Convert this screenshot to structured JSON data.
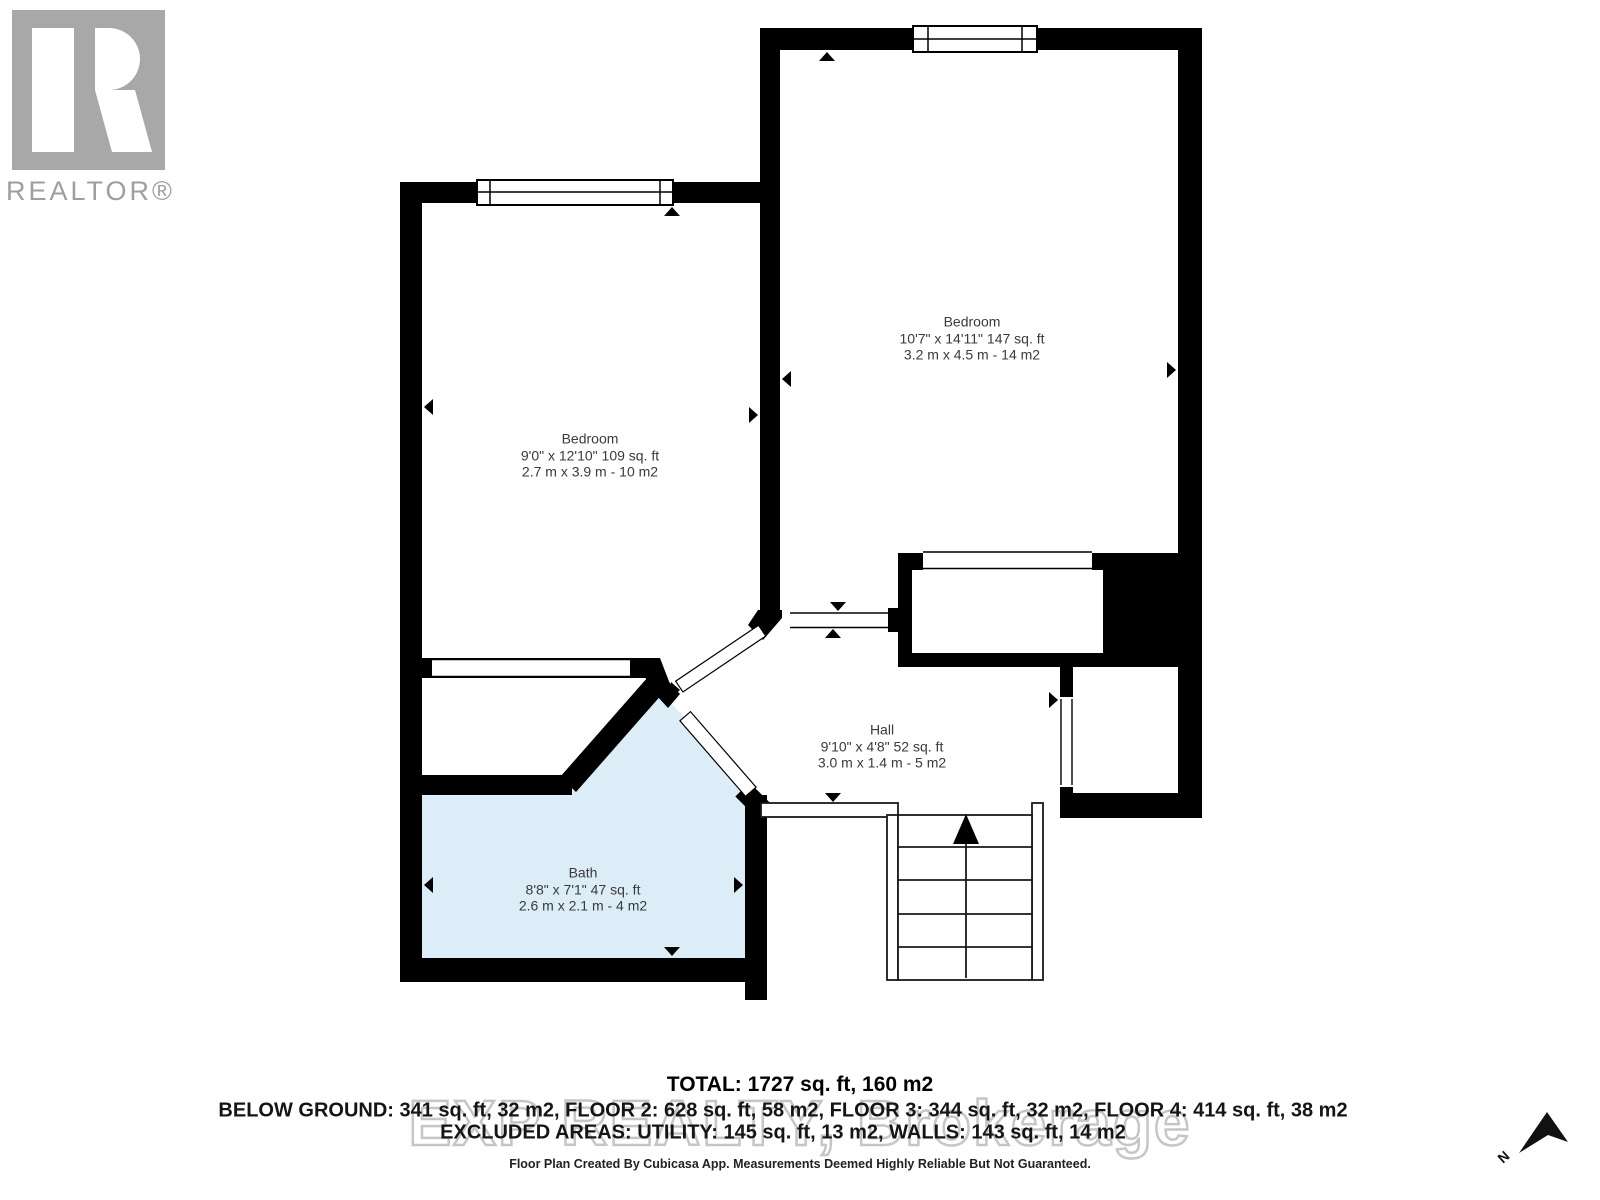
{
  "branding": {
    "realtor_logo_text": "REALTOR®"
  },
  "rooms": [
    {
      "id": "bedroom-right",
      "name": "Bedroom",
      "imperial": "10'7\" x 14'11\" 147 sq. ft",
      "metric": "3.2 m x 4.5 m - 14 m2"
    },
    {
      "id": "bedroom-left",
      "name": "Bedroom",
      "imperial": "9'0\" x 12'10\" 109 sq. ft",
      "metric": "2.7 m x 3.9 m - 10 m2"
    },
    {
      "id": "hall",
      "name": "Hall",
      "imperial": "9'10\" x 4'8\" 52 sq. ft",
      "metric": "3.0 m x 1.4 m - 5 m2"
    },
    {
      "id": "bath",
      "name": "Bath",
      "imperial": "8'8\" x 7'1\" 47 sq. ft",
      "metric": "2.6 m x 2.1 m - 4 m2"
    }
  ],
  "summary": {
    "total": "TOTAL: 1727 sq. ft, 160 m2",
    "floors": "BELOW GROUND: 341 sq. ft, 32 m2, FLOOR 2: 628 sq. ft, 58 m2, FLOOR 3: 344 sq. ft, 32 m2, FLOOR 4: 414 sq. ft, 38 m2",
    "excluded": "EXCLUDED AREAS: UTILITY: 145 sq. ft, 13 m2, WALLS: 143 sq. ft, 14 m2"
  },
  "watermark": "EXP REALTY, Brokerage",
  "footer": "Floor Plan Created By Cubicasa App. Measurements Deemed Highly Reliable But Not Guaranteed.",
  "compass": {
    "north_label": "N"
  },
  "colors": {
    "wall": "#000000",
    "bath_fill": "#ddedf8",
    "label_text": "#3a3a3a",
    "logo_gray": "#a8a8a8",
    "watermark_gray": "#c6c6c6"
  }
}
